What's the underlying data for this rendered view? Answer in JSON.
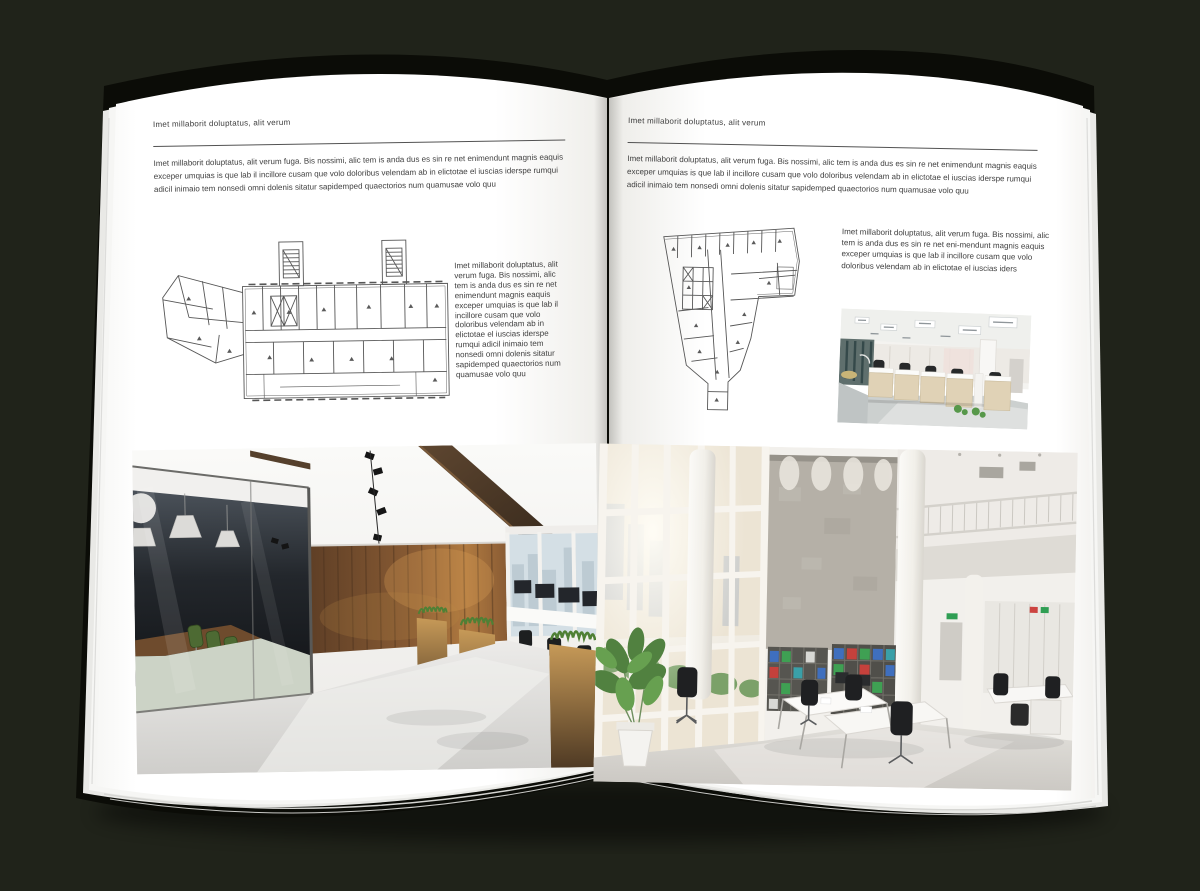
{
  "document": {
    "type": "interior-design brochure spread mockup",
    "background_color": "#20231a",
    "page_color": "#ffffff",
    "text_color": "#404040",
    "accent_wood_color": "#7b5433",
    "accent_green_color": "#4d6a33"
  },
  "left_page": {
    "kicker": "Imet millaborit doluptatus, alit verum",
    "intro": "Imet millaborit doluptatus, alit verum fuga. Bis nossimi, alic tem is anda dus es sin re net enimendunt magnis eaquis exceper umquias is que lab il incillore cusam que volo doloribus velendam ab in elictotae el iuscias iderspe rumqui adicil inimaio tem nonsedi omni dolenis sitatur sapidemped quaectorios num quamusae volo quu",
    "floor_plan": "wide-building-floor-plan",
    "caption": "Imet millaborit doluptatus, alit verum fuga. Bis nossimi, alic tem is anda dus es sin re net enimendunt magnis eaquis exceper umquias is que lab il incillore cusam que volo doloribus velendam ab in elictotae el iuscias iderspe rumqui adicil inimaio tem nonsedi omni dolenis sitatur sapidemped quaectorios num quamusae volo quu",
    "photo": "dark-wood-office-with-glass-meeting-room"
  },
  "right_page": {
    "kicker": "Imet millaborit doluptatus, alit verum",
    "intro": "Imet millaborit doluptatus, alit verum fuga. Bis nossimi, alic tem is anda dus es sin re net enimendunt magnis eaquis exceper umquias is que lab il incillore cusam que volo doloribus velendam ab in elictotae el iuscias iderspe rumqui adicil inimaio tem nonsedi omni dolenis sitatur sapidemped quaectorios num quamusae volo quu",
    "floor_plan": "wedge-building-floor-plan",
    "caption": "Imet millaborit doluptatus, alit verum fuga. Bis nossimi, alic tem is anda dus es sin re net eni-mendunt magnis eaquis exceper umquias is que lab il incillore cusam que volo doloribus velendam ab in elictotae el iuscias iders",
    "photo_small": "open-plan-cubicle-office",
    "photo_large": "double-height-white-office-with-bookshelves"
  }
}
